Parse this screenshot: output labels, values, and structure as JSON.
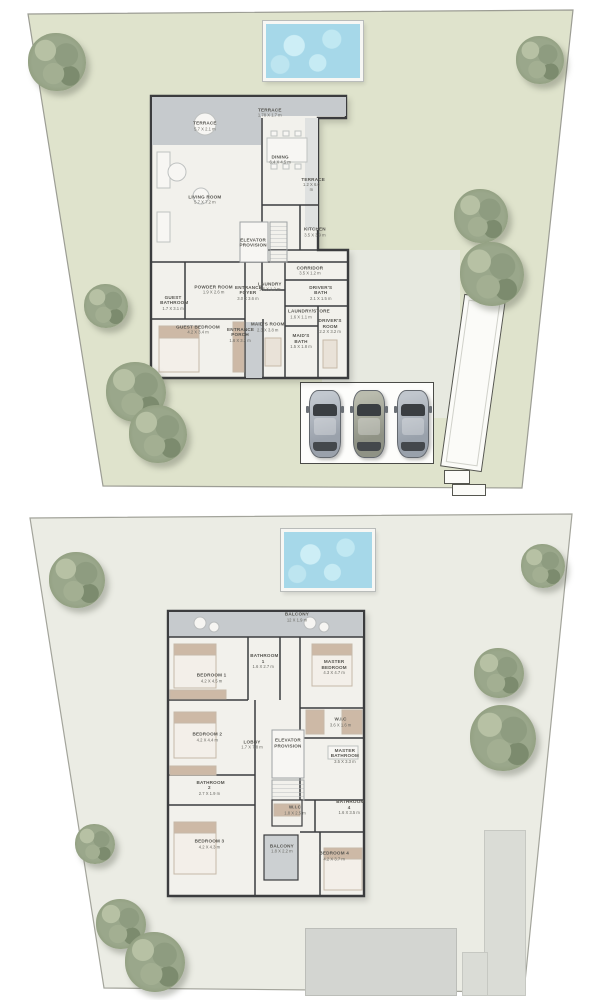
{
  "palette": {
    "lot_green": "#dfe3cc",
    "lot_pale": "#ebece4",
    "pool_blue": "#a6d8e9",
    "terrace_gray": "#c6cacd",
    "wall_dark": "#3b3c3e",
    "floor_white": "#f2f1ec",
    "accent_tan": "#cdb9a6",
    "tree_olive": "#9aa78b"
  },
  "floors": [
    {
      "id": "ground-floor",
      "rooms": [
        {
          "label": "TERRACE",
          "dims": "5.7 X 2.1 m",
          "x": 28.8,
          "y": 11
        },
        {
          "label": "TERRACE",
          "dims": "1.78 X 1.7 m",
          "x": 60,
          "y": 6.5
        },
        {
          "label": "DINING",
          "dims": "6.4 X 4.5 m",
          "x": 65,
          "y": 22.5
        },
        {
          "label": "TERRACE",
          "dims": "1.2 X 6.0 m",
          "x": 80,
          "y": 31,
          "w": 20
        },
        {
          "label": "LIVING ROOM",
          "dims": "5.7 X 7.2 m",
          "x": 28.8,
          "y": 36.3
        },
        {
          "label": "ELEVATOR PROVISION",
          "x": 52,
          "y": 51,
          "w": 30
        },
        {
          "label": "KITCHEN",
          "dims": "3.5 X 3.9 m",
          "x": 81.7,
          "y": 47.3
        },
        {
          "label": "CORRIDOR",
          "dims": "3.5 X 1.2 m",
          "x": 79.3,
          "y": 60.5
        },
        {
          "label": "POWDER ROOM",
          "dims": "1.9 X 2.6 m",
          "x": 33,
          "y": 67
        },
        {
          "label": "GUEST BATHROOM",
          "dims": "1.7 X 3.1 m",
          "x": 13.5,
          "y": 71.5,
          "w": 26
        },
        {
          "label": "ENTRANCE FOYER",
          "dims": "3.0 X 3.6 m",
          "x": 49.5,
          "y": 68,
          "w": 26
        },
        {
          "label": "LAUNDRY",
          "dims": "1.6 X 1.2 m",
          "x": 60,
          "y": 66
        },
        {
          "label": "DRIVER'S BATH",
          "dims": "2.1 X 1.5 m",
          "x": 84.5,
          "y": 68,
          "w": 26
        },
        {
          "label": "GUEST BEDROOM",
          "dims": "4.2 X 3.4 m",
          "x": 25.5,
          "y": 80.8
        },
        {
          "label": "ENTRANCE PORCH",
          "dims": "1.6 X 3.3 m",
          "x": 45.7,
          "y": 82.5,
          "w": 26
        },
        {
          "label": "MAID'S ROOM",
          "dims": "2.3 X 3.8 m",
          "x": 59,
          "y": 79.8
        },
        {
          "label": "LAUNDRY/STORE",
          "dims": "1.6 X 1.1 m",
          "x": 75,
          "y": 75.5,
          "w": 26
        },
        {
          "label": "MAID'S BATH",
          "dims": "1.5 X 1.8 m",
          "x": 75,
          "y": 84.6,
          "w": 26
        },
        {
          "label": "DRIVER'S ROOM",
          "dims": "2.2 X 3.2 m",
          "x": 89,
          "y": 79.5,
          "w": 26
        }
      ],
      "trees": [
        {
          "x": 57,
          "y": 62,
          "s": 58
        },
        {
          "x": 540,
          "y": 60,
          "s": 48
        },
        {
          "x": 481,
          "y": 216,
          "s": 54
        },
        {
          "x": 492,
          "y": 274,
          "s": 64
        },
        {
          "x": 106,
          "y": 306,
          "s": 44
        },
        {
          "x": 136,
          "y": 392,
          "s": 60
        },
        {
          "x": 158,
          "y": 434,
          "s": 58
        }
      ],
      "cars": [
        {
          "body": "#9aa1ab",
          "light": "#c2c8cf"
        },
        {
          "body": "#8f9285",
          "light": "#babcae"
        },
        {
          "body": "#99a1ab",
          "light": "#c0c6cd"
        }
      ]
    },
    {
      "id": "first-floor",
      "rooms": [
        {
          "label": "BALCONY",
          "dims": "12 X 1.9 m",
          "x": 63.7,
          "y": 5.6
        },
        {
          "label": "BEDROOM 1",
          "dims": "4.2 X 4.5 m",
          "x": 24,
          "y": 25.6
        },
        {
          "label": "BATHROOM 1",
          "dims": "1.6 X 2.7 m",
          "x": 48,
          "y": 20,
          "w": 26
        },
        {
          "label": "MASTER BEDROOM",
          "dims": "4.3 X 4.7 m",
          "x": 81,
          "y": 22,
          "w": 36
        },
        {
          "label": "BEDROOM 2",
          "dims": "4.2 X 4.4 m",
          "x": 22,
          "y": 45
        },
        {
          "label": "W.I.C",
          "dims": "3.6 X 1.6 m",
          "x": 84,
          "y": 40
        },
        {
          "label": "LOBBY",
          "dims": "1.7 X 7.8 m",
          "x": 42.8,
          "y": 47.5
        },
        {
          "label": "ELEVATOR PROVISION",
          "x": 59.5,
          "y": 47,
          "w": 30
        },
        {
          "label": "MASTER BATHROOM",
          "dims": "3.5 X 3.3 m",
          "x": 86,
          "y": 51,
          "w": 36
        },
        {
          "label": "BATHROOM 2",
          "dims": "2.7 X 1.9 m",
          "x": 23,
          "y": 61.5,
          "w": 26
        },
        {
          "label": "BATHROOM 4",
          "dims": "1.6 X 3.5 m",
          "x": 88,
          "y": 68,
          "w": 26
        },
        {
          "label": "W.I.C",
          "dims": "1.8 X 2.5 m",
          "x": 62.8,
          "y": 69
        },
        {
          "label": "BEDROOM 3",
          "dims": "4.2 X 4.3 m",
          "x": 23,
          "y": 80
        },
        {
          "label": "BALCONY",
          "dims": "1.8 X 2.2 m",
          "x": 56.7,
          "y": 81.5,
          "w": 26
        },
        {
          "label": "BEDROOM 4",
          "dims": "4.2 X 3.7 m",
          "x": 81,
          "y": 84
        }
      ],
      "trees": [
        {
          "x": 77,
          "y": 80,
          "s": 56
        },
        {
          "x": 543,
          "y": 66,
          "s": 44
        },
        {
          "x": 499,
          "y": 173,
          "s": 50
        },
        {
          "x": 503,
          "y": 238,
          "s": 66
        },
        {
          "x": 95,
          "y": 344,
          "s": 40
        },
        {
          "x": 121,
          "y": 424,
          "s": 50
        },
        {
          "x": 155,
          "y": 462,
          "s": 60
        }
      ]
    }
  ]
}
